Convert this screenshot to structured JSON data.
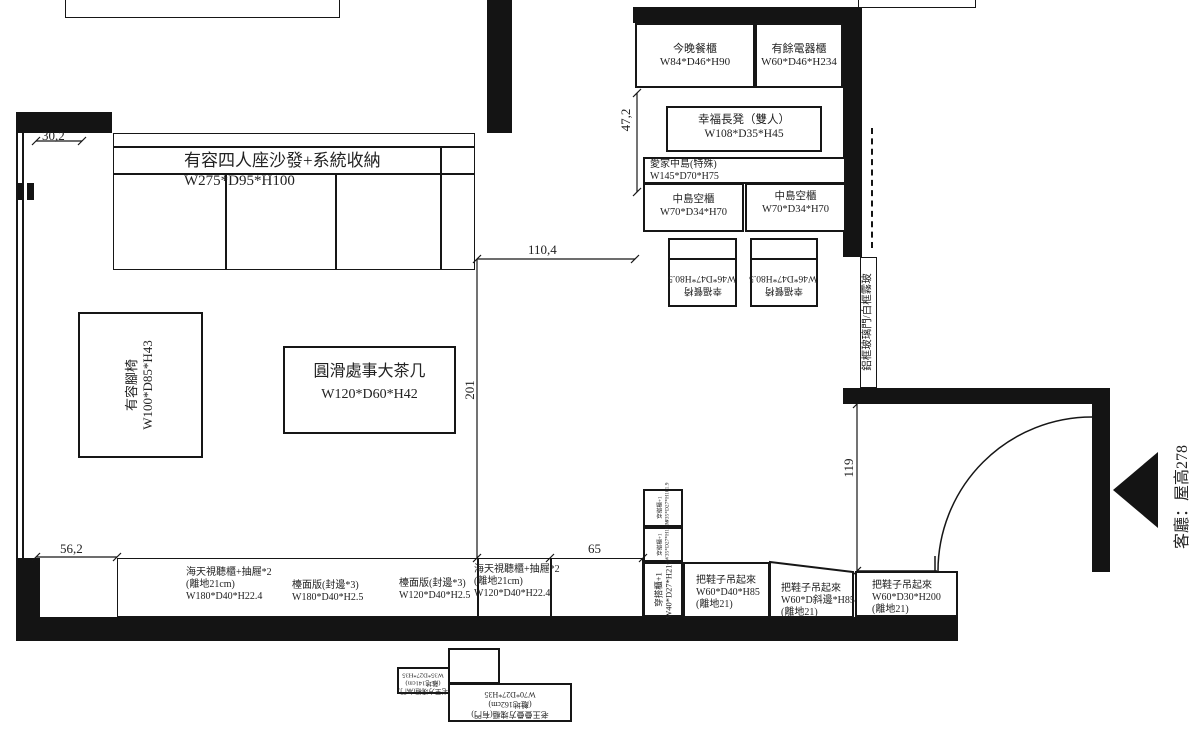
{
  "room": {
    "label": "客廳：屋高278"
  },
  "door": {
    "glass_label": "鋁框玻璃門/白框霧玻"
  },
  "dims": {
    "wall_top_left": "30,2",
    "island_side": "47,2",
    "opening_width": "110,4",
    "room_depth": "201",
    "entry_width": "119",
    "tv_offset": "56,2",
    "gap": "65"
  },
  "items": {
    "sofa": {
      "name": "有容四人座沙發+系統收納",
      "dim": "W275*D95*H100"
    },
    "footstool": {
      "name": "有容腳椅",
      "dim": "W100*D85*H43"
    },
    "coffee_table": {
      "name": "圓滑處事大茶几",
      "dim": "W120*D60*H42"
    },
    "dining_cabinet": {
      "name": "今晚餐櫃",
      "dim": "W84*D46*H90"
    },
    "appliance_cabinet": {
      "name": "有餘電器櫃",
      "dim": "W60*D46*H234"
    },
    "bench": {
      "name": "幸福長凳（雙人）",
      "dim": "W108*D35*H45"
    },
    "island": {
      "name": "愛家中島(特殊)",
      "dim": "W145*D70*H75"
    },
    "island_cabinet": {
      "name": "中島空櫃",
      "dim": "W70*D34*H70"
    },
    "dining_chair": {
      "name": "幸福餐椅",
      "dim": "W46*D47*H80.5"
    },
    "av_cabinet_180": {
      "name": "海天視聽櫃+抽屜*2",
      "note": "(離地21cm)",
      "dim": "W180*D40*H22.4"
    },
    "counter_180": {
      "name": "檯面版(封邊*3)",
      "dim": "W180*D40*H2.5"
    },
    "counter_120": {
      "name": "檯面版(封邊*3)",
      "dim": "W120*D40*H2.5"
    },
    "av_cabinet_120": {
      "name": "海天視聽櫃+抽屜*2",
      "note": "(離地21cm)",
      "dim": "W120*D40*H22.4"
    },
    "wardrobe_tall": {
      "name": "穿搭櫃+1",
      "dim": "W40*D27*H219"
    },
    "wardrobe_small": {
      "name": "穿搭櫃+1",
      "dim": "W35*D27*H101.9"
    },
    "shoe_cabinet_a": {
      "name": "把鞋子吊起來",
      "dim": "W60*D40*H85",
      "note": "(離地21)"
    },
    "shoe_cabinet_b": {
      "name": "把鞋子吊起來",
      "dim": "W60*D斜邊*H85",
      "note": "(離地21)"
    },
    "shoe_cabinet_c": {
      "name": "把鞋子吊起來",
      "dim": "W60*D30*H200",
      "note": "(離地21)"
    },
    "cube_cabinet_small": {
      "name": "老王方塊櫃(無門)",
      "note": "(離地141cm)",
      "dim": "W35*D27*H35"
    },
    "cube_cabinet_large": {
      "name": "老王疊疊方塊櫃(有門)",
      "note": "(離地162cm)",
      "dim": "W70*D27*H35"
    }
  }
}
